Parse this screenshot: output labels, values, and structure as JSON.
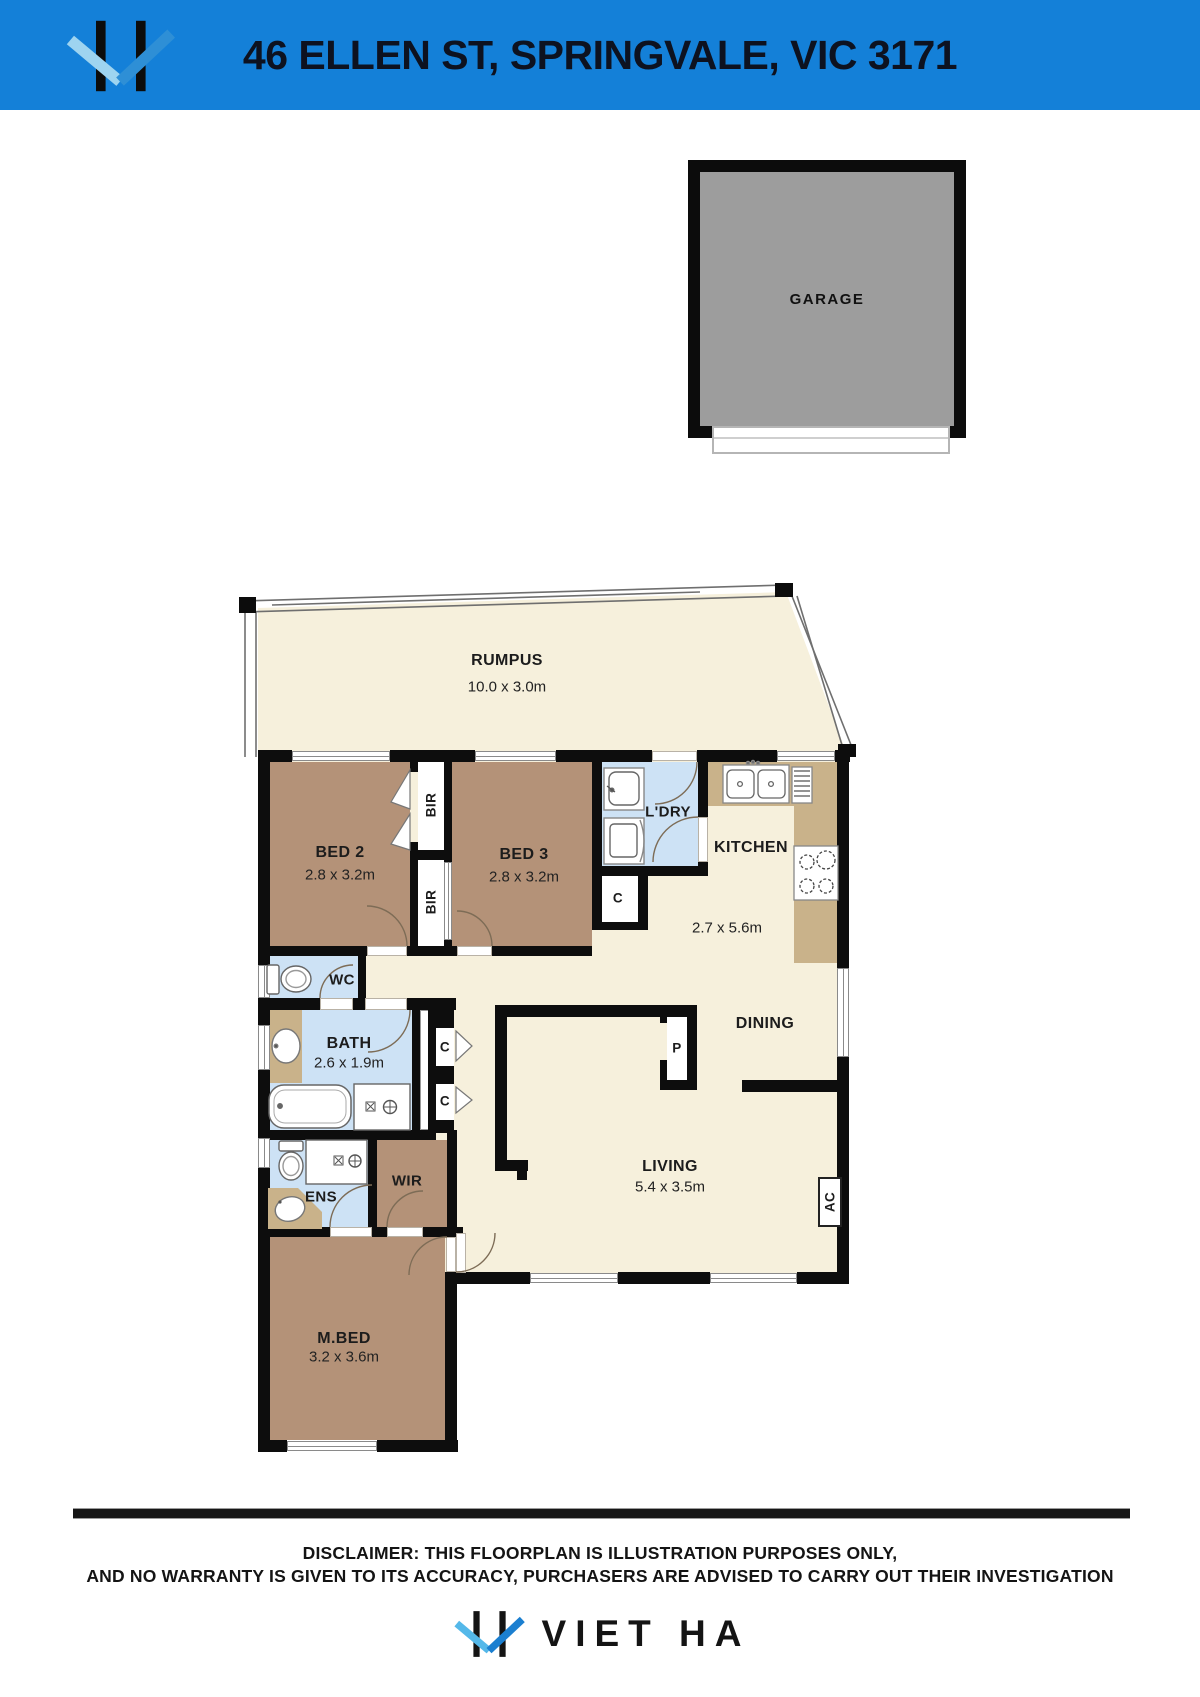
{
  "header": {
    "title": "46 ELLEN ST, SPRINGVALE, VIC 3171"
  },
  "garage": {
    "label": "GARAGE"
  },
  "rooms": {
    "rumpus": {
      "name": "RUMPUS",
      "dims": "10.0 x 3.0m"
    },
    "bed2": {
      "name": "BED 2",
      "dims": "2.8 x 3.2m"
    },
    "bed3": {
      "name": "BED 3",
      "dims": "2.8 x 3.2m"
    },
    "laundry": {
      "name": "L'DRY"
    },
    "kitchen": {
      "name": "KITCHEN",
      "dims": "2.7 x 5.6m"
    },
    "dining": {
      "name": "DINING"
    },
    "living": {
      "name": "LIVING",
      "dims": "5.4 x 3.5m"
    },
    "wc": {
      "name": "WC"
    },
    "bath": {
      "name": "BATH",
      "dims": "2.6 x 1.9m"
    },
    "ens": {
      "name": "ENS"
    },
    "wir": {
      "name": "WIR"
    },
    "master_bed": {
      "name": "M.BED",
      "dims": "3.2 x 3.6m"
    }
  },
  "fixtures": {
    "bir_top": "BIR",
    "bir_bottom": "BIR",
    "cupboard_hall": "C",
    "cupboard_1": "C",
    "cupboard_2": "C",
    "pantry": "P",
    "ac": "AC"
  },
  "disclaimer": {
    "line1": "DISCLAIMER: THIS FLOORPLAN IS ILLUSTRATION PURPOSES ONLY,",
    "line2": "AND NO WARRANTY IS GIVEN TO ITS ACCURACY, PURCHASERS ARE ADVISED TO CARRY OUT THEIR INVESTIGATION"
  },
  "footer": {
    "brand": "VIET HA"
  },
  "colors": {
    "header_blue": "#1480d8",
    "floor_cream": "#f6f0dc",
    "room_brown": "#b49278",
    "wet_blue": "#cde2f5",
    "counter_tan": "#c9b28a",
    "garage_gray": "#9d9d9d",
    "wall_black": "#0d0d0d",
    "logo_blue_light": "#54b8e9",
    "logo_blue_dark": "#1b7fd0"
  }
}
